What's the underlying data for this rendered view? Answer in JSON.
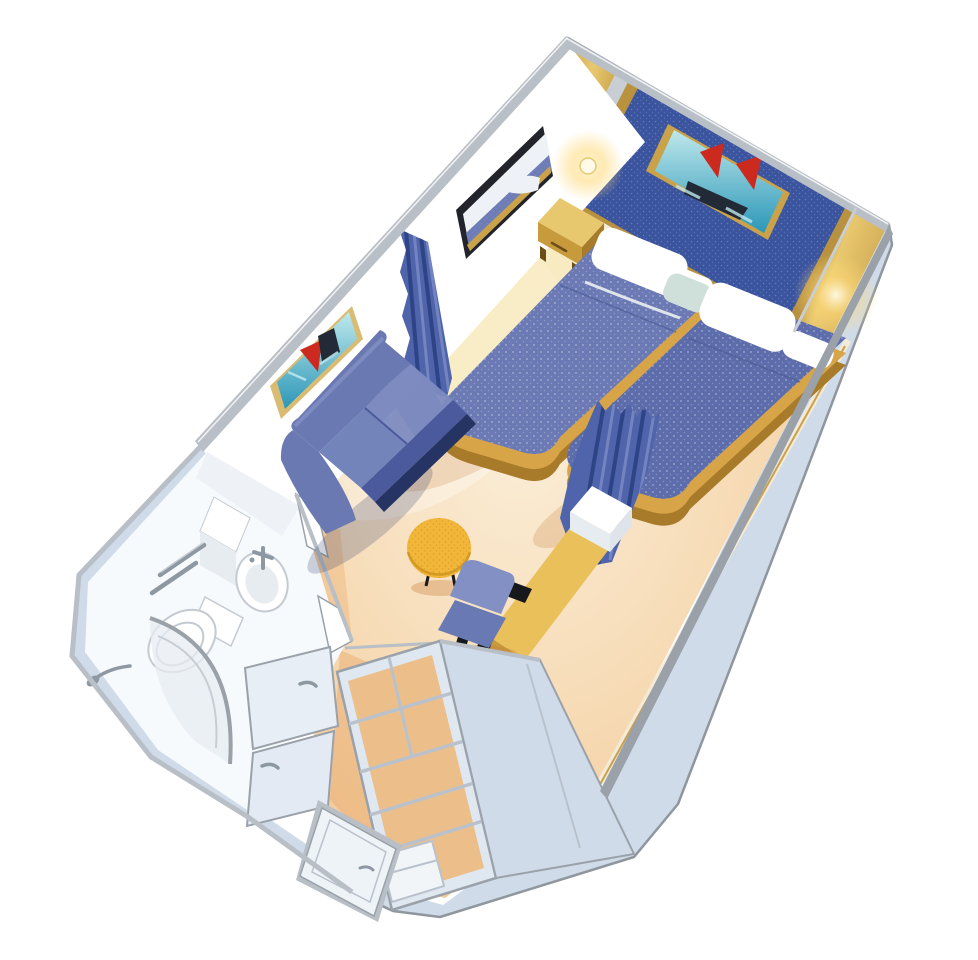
{
  "scene": {
    "name": "cruise-cabin-3d-cutaway-floorplan",
    "background": "#ffffff"
  },
  "palette": {
    "background": "#ffffff",
    "exteriorWall": "#cfdbe9",
    "outline": "#8f969e",
    "capGray": "#b9bfc6",
    "capDark": "#9aa1a9",
    "wallWhite": "#ffffff",
    "wallShade": "#f2f5f8",
    "goldDeep": "#6b4d15",
    "gold": "#c9a14e",
    "goldBright": "#e8c86e",
    "goldFrame": "#b9923f",
    "trimSilver": "#c9ced4",
    "panelBlue": "#3b549e",
    "panelDot": "#8fa0d8",
    "pictureFrame": "#c9a24a",
    "pictureFrameLight": "#d9bc72",
    "seaTeal": "#2b97b8",
    "seaLight": "#bfe8ec",
    "sailRed": "#cc2a1e",
    "shipDark": "#222a38",
    "mirrorFrame": "#23242b",
    "mirrorRefl": "#eef2f6",
    "mirrorBed": "#6e7db6",
    "bedBlue": "#6b7ab4",
    "bedBlueDark": "#5d6dab",
    "bedShade": "#4d5c96",
    "bedBase": "#d7a548",
    "bedBaseDark": "#a87b2a",
    "pillowWhite": "#ffffff",
    "pillowShade": "#dfe3ea",
    "mint": "#cfe0da",
    "curtain": "#4f64aa",
    "curtainDark": "#2e4487",
    "curtainLight": "#7484c0",
    "sofaBack": "#6a79b2",
    "sofaCushion": "#7d8bc0",
    "sofaCushion2": "#7384ba",
    "sofaSide": "#4a5a9c",
    "sofaBase": "#263463",
    "tableYellow": "#f2b63a",
    "tableSpeck": "#c9931d",
    "chairBack": "#8290c4",
    "chairSeat": "#6979b4",
    "chairFrame": "#17181c",
    "deskGold": "#e9c05a",
    "deskEdge": "#c79a3c",
    "floorPeach": "#f6d9b2",
    "floorCream": "#fbeed8",
    "floorEdge": "#efc08b",
    "floorOrange": "#e9a96b",
    "yellowGlow": "#f8ecc0",
    "bathFloor": "#f7fafc",
    "fixtureWhite": "#ffffff",
    "fixtureShade": "#e7ecf1",
    "fixtureLine": "#c3cad1",
    "chrome": "#8d98a3",
    "chromeLight": "#c6cdd4",
    "closetPanel": "#dfe7f0",
    "closetBack": "#ecbf8a",
    "panelFace": "#e8eef6",
    "panelFace2": "#e3eaf3",
    "doorFace": "#eef3f8",
    "shelfLine": "#b9c2cc",
    "lampCore": "#fffbe8",
    "lampGlow": "#ffd978",
    "shadowWarm": "#c87f3a",
    "baseboardCream": "#f3ead8"
  },
  "objects": {
    "room": "stateroom-cutaway",
    "items": [
      "twin-bed-left",
      "twin-bed-right",
      "headboard-panel",
      "ship-picture-headboard",
      "wall-lamp",
      "nightstand",
      "mirror",
      "ship-picture-sofa-wall",
      "privacy-curtain",
      "bed-foot-curtain",
      "loveseat-sofa",
      "coffee-table",
      "desk-chair",
      "vanity-desk",
      "white-cabinet",
      "bathroom",
      "sink",
      "toilet",
      "shower",
      "towel-bars",
      "bathroom-door",
      "wardrobe-shelves",
      "closet-top-panel",
      "entry-door"
    ]
  }
}
